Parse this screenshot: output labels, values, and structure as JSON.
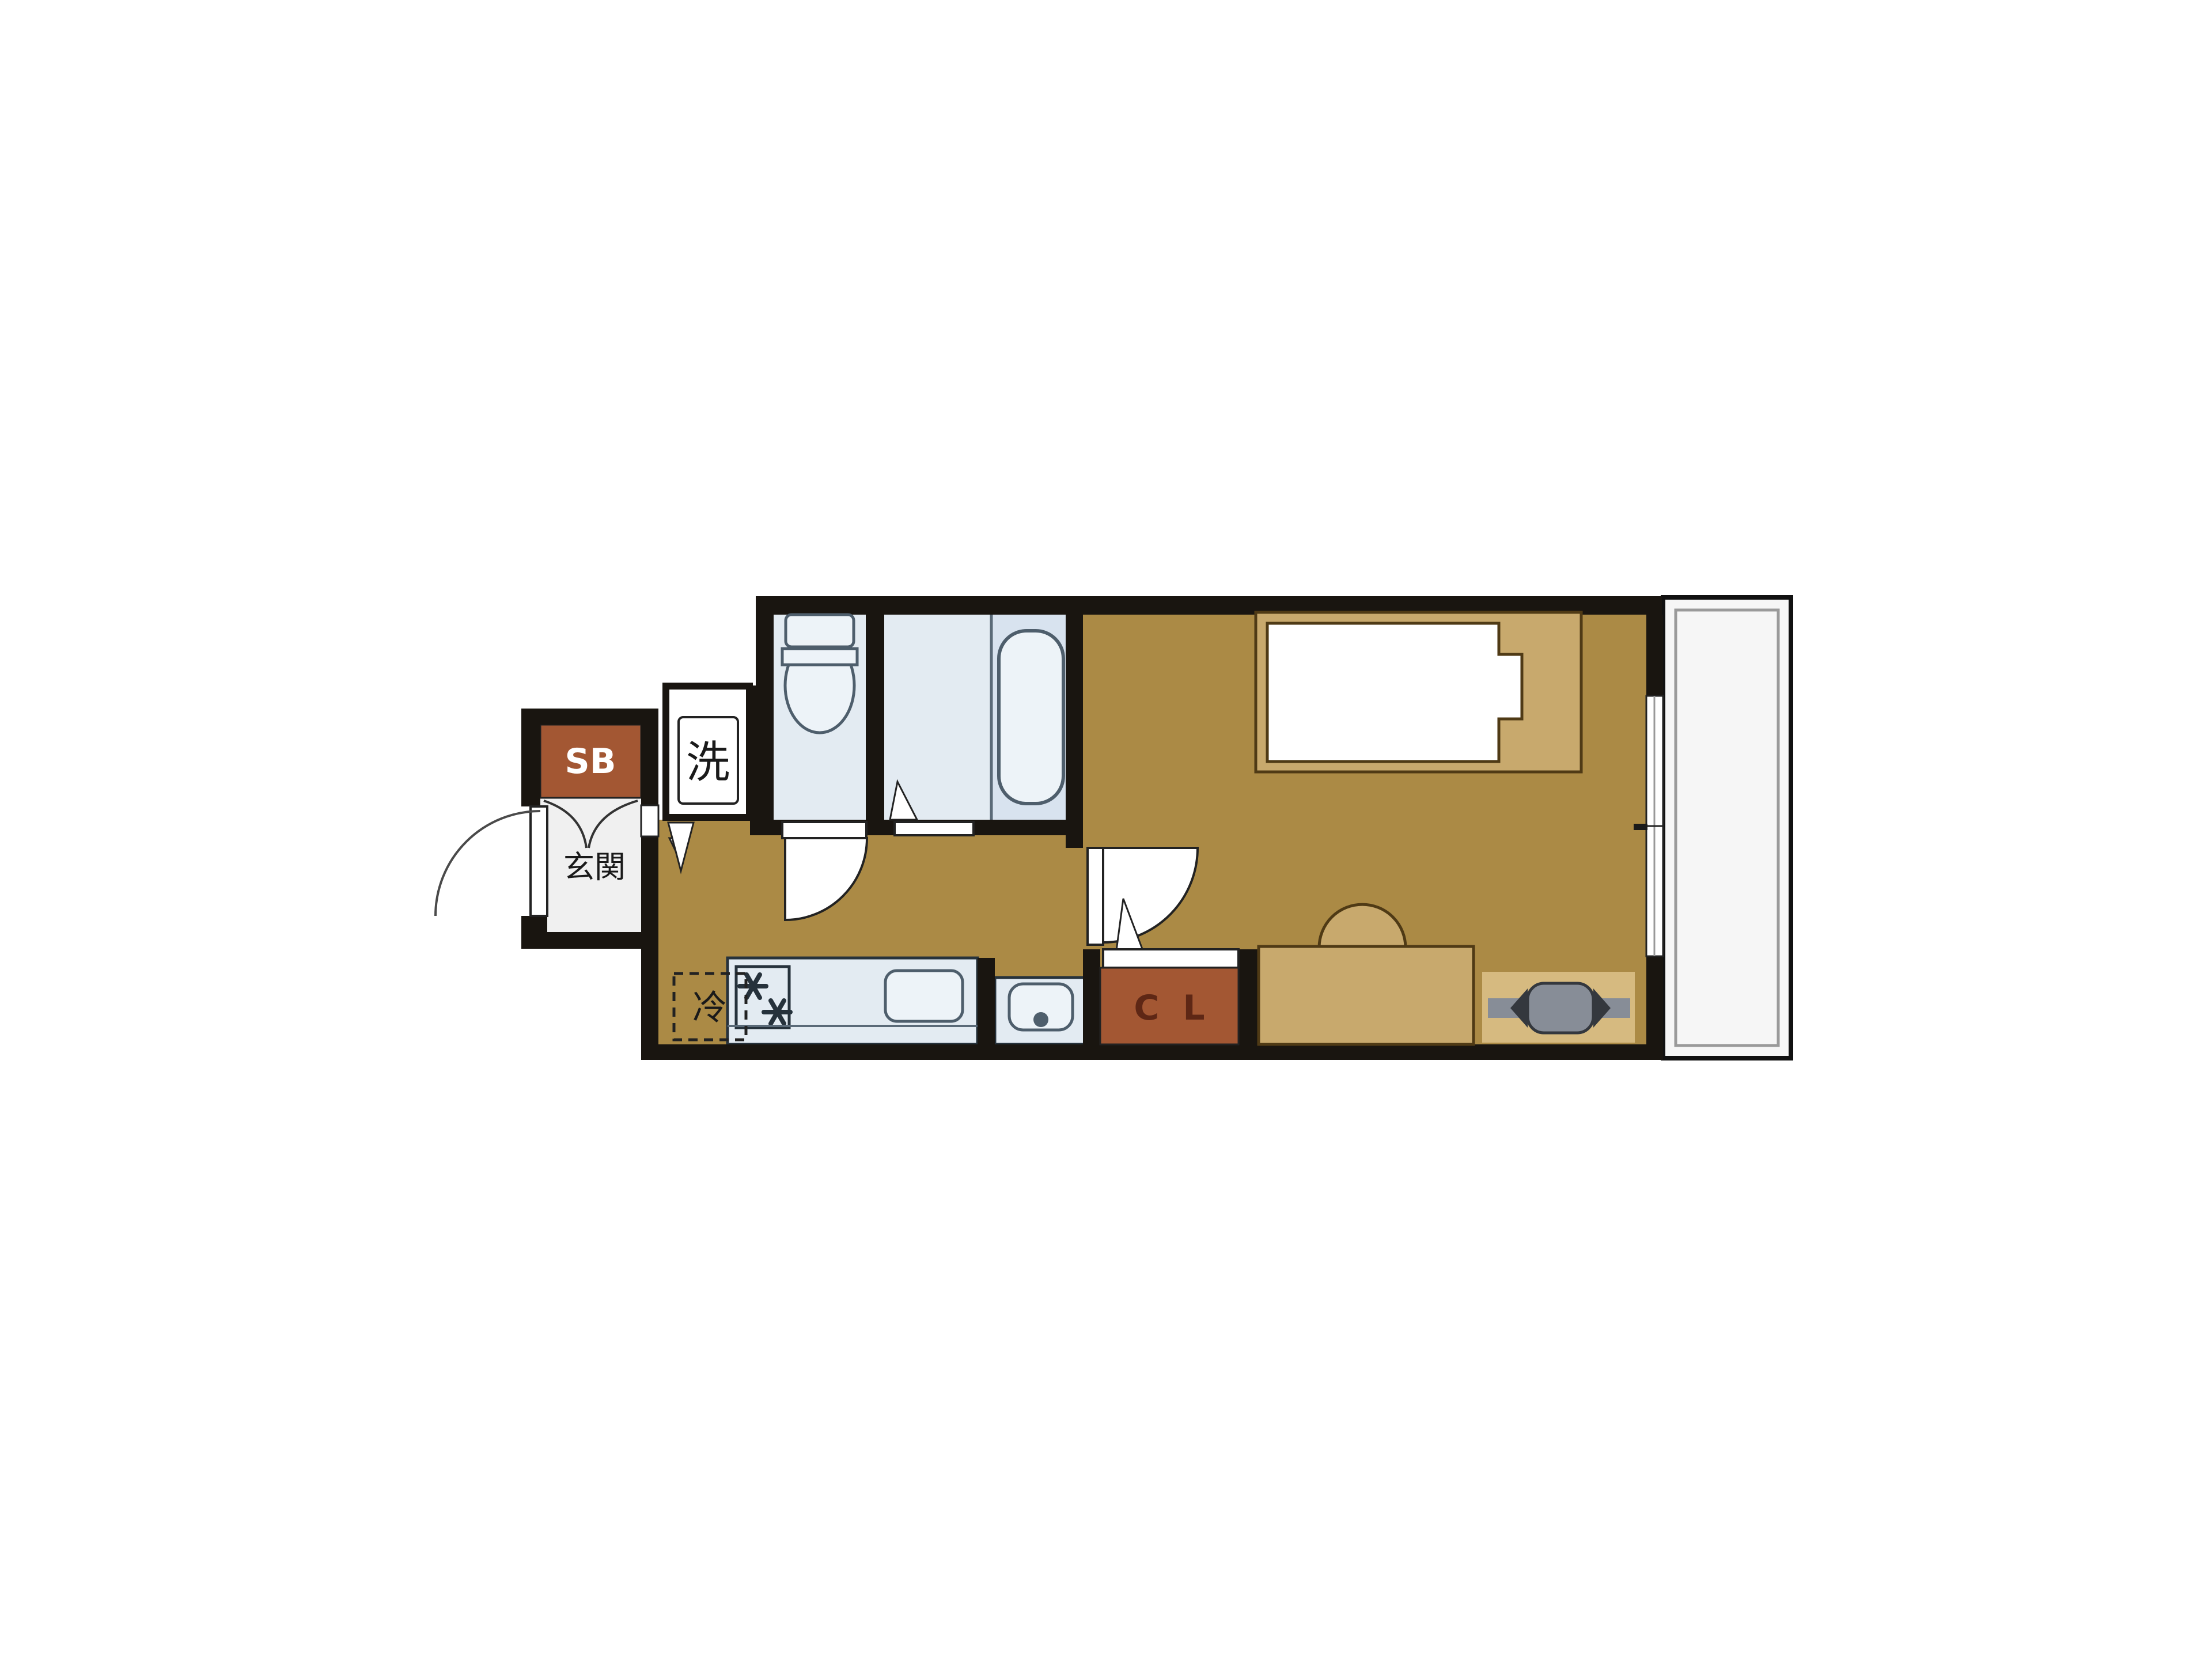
{
  "floorplan": {
    "title": "studio-apartment-floor-plan",
    "labels": {
      "shoe_box": "SB",
      "entrance": "玄関",
      "washing_machine": "洗",
      "refrigerator": "冷",
      "closet": "C L"
    },
    "colors": {
      "wall": "#191510",
      "floor_wood": "#ab8a45",
      "furniture_tan": "#c8a96d",
      "furniture_tan_light": "#d6ba80",
      "accent_brown": "#a35733",
      "wet_area": "#e3ebf2",
      "wet_area_dark": "#d8e3ef",
      "fixture_fill": "#edf3f8",
      "white": "#ffffff",
      "genkan_floor": "#f0f0f0",
      "balcony_fill": "#f6f6f6",
      "ac_gray": "#878d97",
      "ink": "#1a1a1a",
      "sb_text": "#ffffff",
      "cl_text": "#5e2715"
    }
  }
}
